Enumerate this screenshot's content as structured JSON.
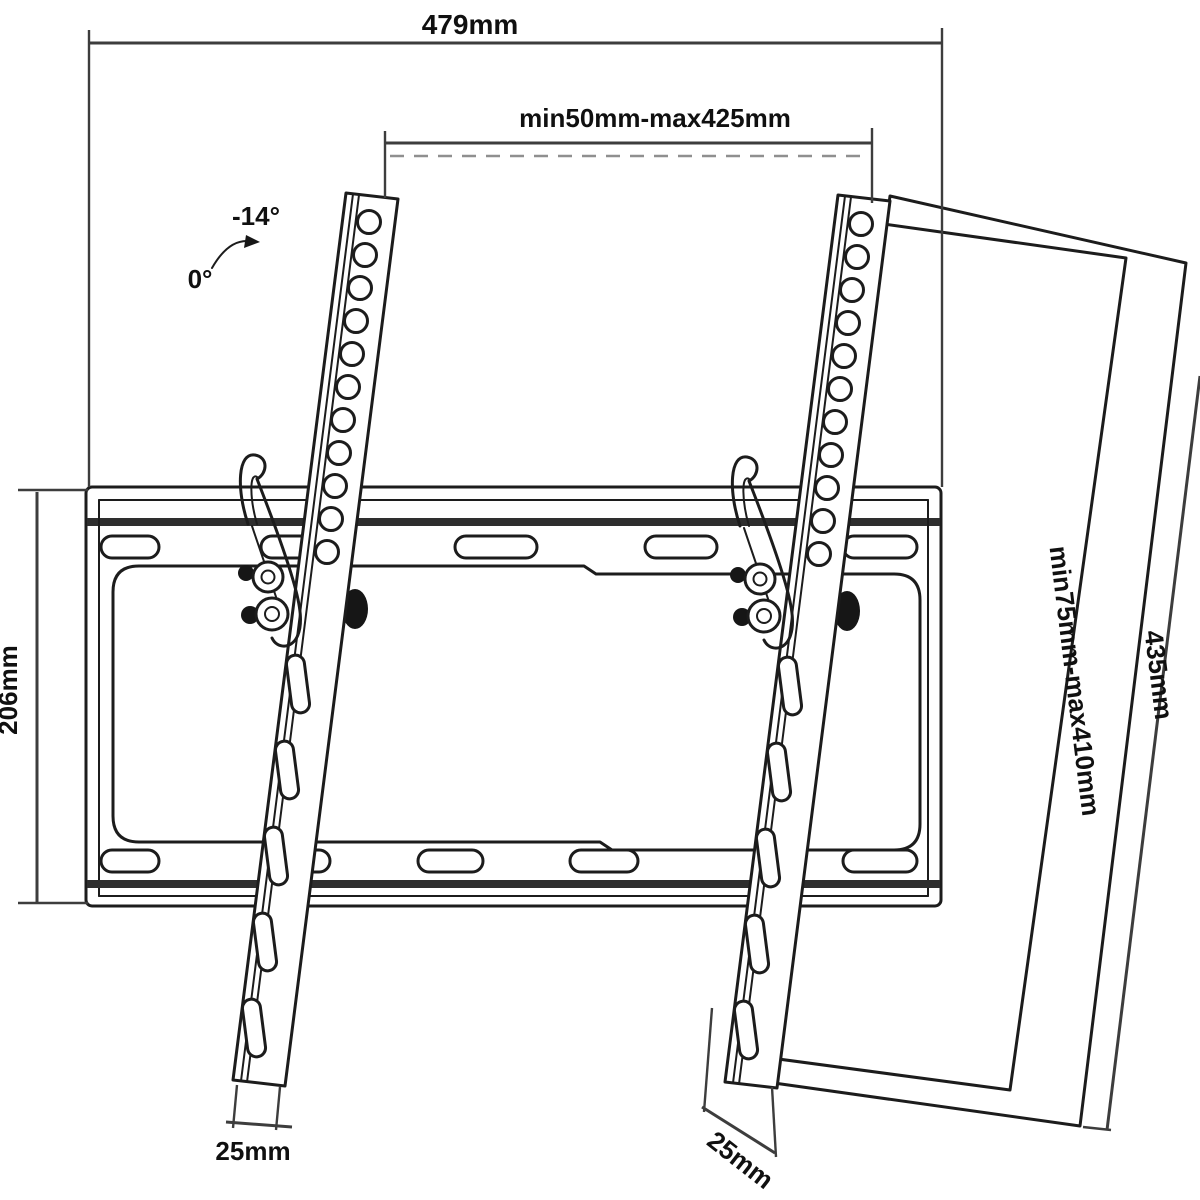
{
  "diagram": {
    "type": "technical-drawing",
    "subject": "Tilting TV wall mount bracket, dimensioned line drawing",
    "colors": {
      "background": "#ffffff",
      "line": "#1c1c1c",
      "dimension": "#3d3d3d",
      "rail_band": "#2e2e2e"
    },
    "labels": {
      "total_width": "479mm",
      "vesa_width_range": "min50mm-max425mm",
      "plate_height": "206mm",
      "tv_height": "435mm",
      "vesa_height_range": "min75mm-max410mm",
      "arm_width_left": "25mm",
      "arm_width_right": "25mm",
      "tilt_angle_max": "-14°",
      "tilt_angle_rest": "0°"
    },
    "icons": {
      "tilt_arrow": "curved-arrow"
    }
  }
}
